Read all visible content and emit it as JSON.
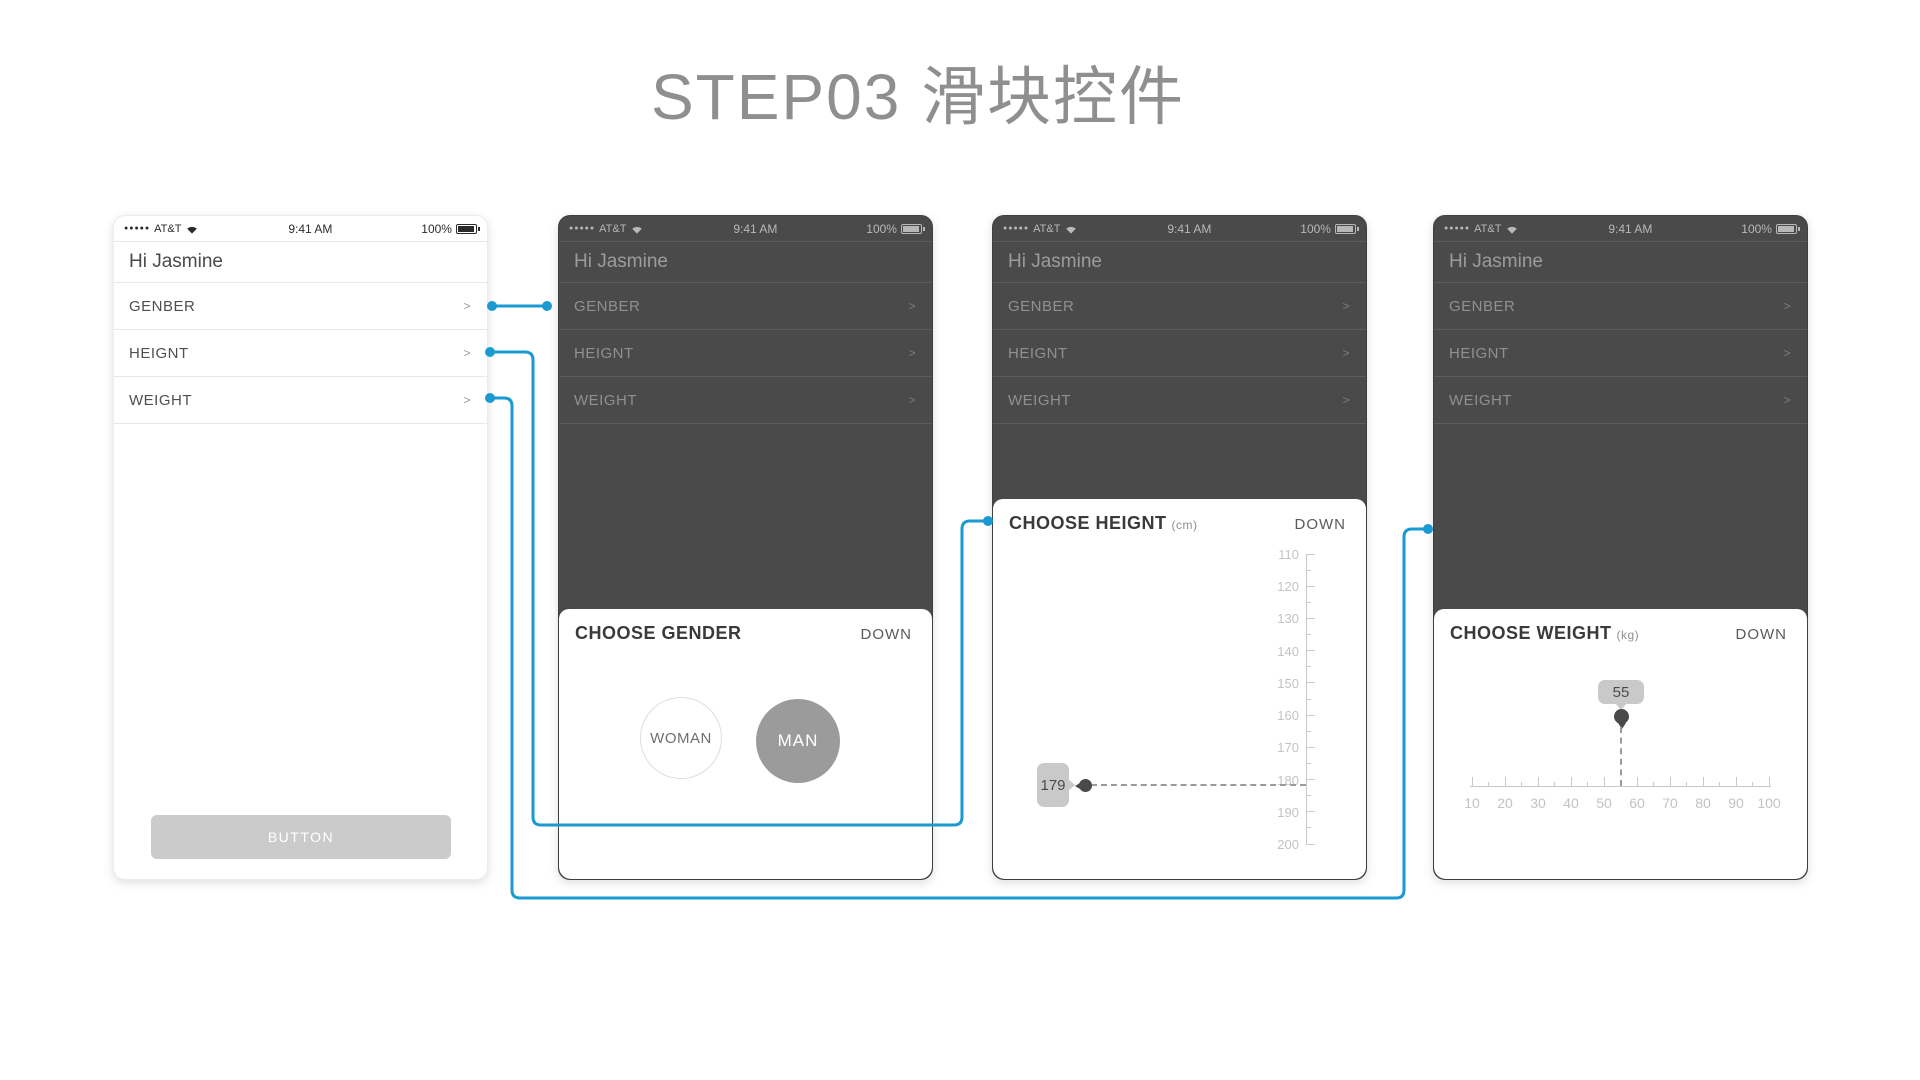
{
  "page": {
    "title": "STEP03 滑块控件",
    "accent_color": "#1b9ad2",
    "dark_overlay_color": "#4a4a4a"
  },
  "status_bar": {
    "signal_dots": "●●●●●",
    "carrier": "AT&T",
    "wifi_icon": "wifi-icon",
    "time": "9:41 AM",
    "battery_percent": "100%"
  },
  "home": {
    "greeting": "Hi Jasmine",
    "rows": [
      {
        "label": "GENBER"
      },
      {
        "label": "HEIGNT"
      },
      {
        "label": "WEIGHT"
      }
    ],
    "chevron": ">",
    "button_label": "BUTTON"
  },
  "gender_sheet": {
    "title": "CHOOSE GENDER",
    "dismiss_label": "DOWN",
    "options": [
      {
        "label": "WOMAN",
        "selected": false
      },
      {
        "label": "MAN",
        "selected": true
      }
    ]
  },
  "height_sheet": {
    "title": "CHOOSE HEIGNT",
    "unit": "(cm)",
    "dismiss_label": "DOWN",
    "value": "179"
  },
  "weight_sheet": {
    "title": "CHOOSE WEIGHT",
    "unit": "(kg)",
    "dismiss_label": "DOWN",
    "value": "55"
  },
  "chart_data": [
    {
      "type": "slider-ruler",
      "name": "height ruler",
      "orientation": "vertical",
      "unit": "cm",
      "min": 110,
      "max": 200,
      "major_step": 10,
      "minor_step": 5,
      "ticks": [
        110,
        120,
        130,
        140,
        150,
        160,
        170,
        180,
        190,
        200
      ],
      "value": 179
    },
    {
      "type": "slider-ruler",
      "name": "weight ruler",
      "orientation": "horizontal",
      "unit": "kg",
      "min": 10,
      "max": 100,
      "major_step": 10,
      "minor_step": 5,
      "ticks": [
        10,
        20,
        30,
        40,
        50,
        60,
        70,
        80,
        90,
        100
      ],
      "value": 55
    }
  ]
}
